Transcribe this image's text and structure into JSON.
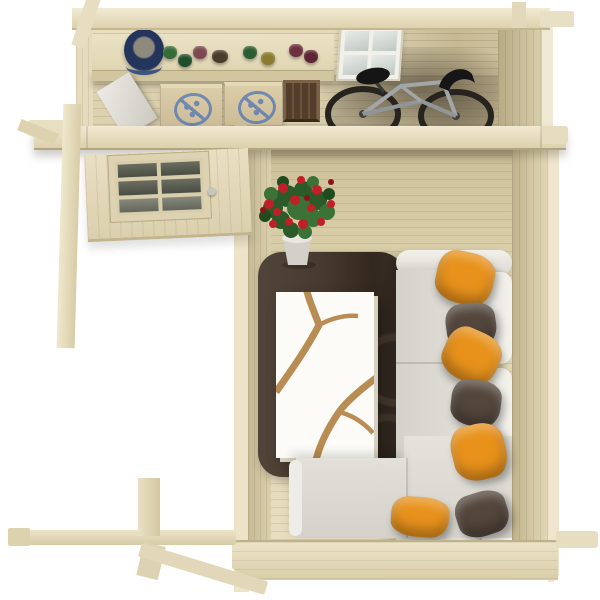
{
  "scene": {
    "title": "Top-down 3D render of a wooden log cabin interior",
    "background": "#ffffff",
    "rooms": [
      "storage-room",
      "living-room"
    ],
    "structure": "log cabin with protruding corner joints, roof removed"
  },
  "palette": {
    "wood_light": "#ece3c8",
    "wood_mid": "#ddd2af",
    "wood_floor": "#ddd3ae",
    "wood_shadow": "#b3a583",
    "plank_line": "#6e5c3a"
  },
  "storage_room": {
    "shelf": {
      "label": "wall shelf with pots"
    },
    "bucket": {
      "color": "#27395f",
      "rim": "#3c5484",
      "contents": "#8d8a7d"
    },
    "pots": [
      {
        "color": "#356b36"
      },
      {
        "color": "#1f4f2a"
      },
      {
        "color": "#7c4950"
      },
      {
        "color": "#4a3b2a"
      },
      {
        "color": "#2c5c31"
      },
      {
        "color": "#8a7c2f"
      },
      {
        "color": "#6e3040"
      },
      {
        "color": "#5d2433"
      }
    ],
    "leaning_board": {
      "color": "#e3e2dc"
    },
    "boxes": [
      {
        "material": "cardboard",
        "logo_color": "#4a72b8"
      },
      {
        "material": "cardboard",
        "logo_color": "#4a72b8"
      }
    ],
    "crate": {
      "color": "#4f3b27"
    },
    "window": {
      "panes": 4,
      "frame": "#f1f0e9",
      "glass": "#d7dcd9"
    },
    "bicycle": {
      "frame": "#a2a6a7",
      "tires": "#27231e",
      "saddle": "#151515"
    }
  },
  "entry": {
    "door": {
      "panes": 6,
      "frame": "#ddd3b2",
      "glass": "#5c5f53",
      "handle": "#c6c6c0"
    }
  },
  "living_room": {
    "plant": {
      "flower": "#c11f27",
      "leaf": "#30602c",
      "pot": "#d2d0c8"
    },
    "rug": {
      "color": "#46392e",
      "ring_pattern": "#6e5c4c"
    },
    "coffee_table": {
      "top": "#fcfbf7",
      "inlay": "#b88c52"
    },
    "sofa": {
      "type": "corner",
      "seat": "#dbd9d2",
      "back": "#eeede7"
    },
    "pillows": [
      {
        "color": "#e8921c",
        "position": "right-1"
      },
      {
        "color": "#53463c",
        "position": "right-2"
      },
      {
        "color": "#e8921c",
        "position": "right-3"
      },
      {
        "color": "#53463c",
        "position": "right-4"
      },
      {
        "color": "#e8921c",
        "position": "right-5"
      },
      {
        "color": "#e8921c",
        "position": "bottom-left"
      },
      {
        "color": "#53463c",
        "position": "bottom-right"
      }
    ]
  }
}
